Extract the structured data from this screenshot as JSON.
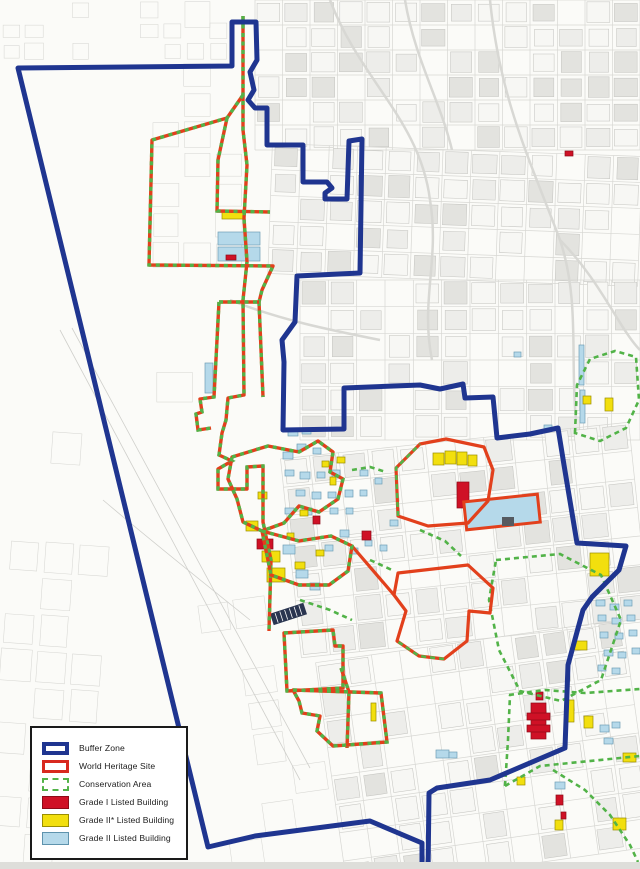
{
  "legend": {
    "items": [
      {
        "key": "buffer-zone",
        "label": "Buffer Zone"
      },
      {
        "key": "world-heritage-site",
        "label": "World Heritage Site"
      },
      {
        "key": "conservation-area",
        "label": "Conservation Area"
      },
      {
        "key": "grade-1-listed",
        "label": "Grade I Listed Building"
      },
      {
        "key": "grade-2-star-listed",
        "label": "Grade II* Listed Building"
      },
      {
        "key": "grade-2-listed",
        "label": "Grade II Listed Building"
      }
    ]
  },
  "map": {
    "width": 640,
    "height": 869,
    "colors": {
      "background": "#fbfbf8",
      "buffer": "#1f3590",
      "whs": "#e2401c",
      "conservation": "#52b348",
      "grade1": "#cf1126",
      "grade1_stroke": "#8e0a18",
      "grade2star": "#f2df0e",
      "grade2star_stroke": "#9a8e00",
      "grade2": "#b5d9ea",
      "grade2_stroke": "#6f9fb5",
      "street_line": "#c6c6c2",
      "street_faint": "#d7d7d3",
      "block_fill_dark": "#e3e3df",
      "block_fill_mid": "#ededea",
      "block_fill_light": "#f7f7f4",
      "road": "#d8d8d4",
      "dark_building": "#2a3550",
      "bottom_strip": "#dededa"
    },
    "streets": {
      "seed": 7,
      "regions": [
        {
          "x": 0,
          "y": 0,
          "w": 230,
          "h": 62,
          "cols": 10,
          "rows": 3,
          "density": 0.55,
          "faint": true,
          "tilt": 0
        },
        {
          "x": 150,
          "y": 0,
          "w": 95,
          "h": 300,
          "cols": 3,
          "rows": 10,
          "density": 0.5,
          "faint": true,
          "tilt": 0
        },
        {
          "x": 255,
          "y": 0,
          "w": 385,
          "h": 150,
          "cols": 14,
          "rows": 6,
          "density": 0.8,
          "faint": false,
          "tilt": 0
        },
        {
          "x": 270,
          "y": 150,
          "w": 370,
          "h": 130,
          "cols": 13,
          "rows": 5,
          "density": 0.75,
          "faint": false,
          "tilt": 2
        },
        {
          "x": 300,
          "y": 280,
          "w": 340,
          "h": 160,
          "cols": 12,
          "rows": 6,
          "density": 0.7,
          "faint": false,
          "tilt": 0
        },
        {
          "x": 290,
          "y": 440,
          "w": 350,
          "h": 200,
          "cols": 12,
          "rows": 7,
          "density": 0.72,
          "faint": false,
          "tilt": -6
        },
        {
          "x": 330,
          "y": 640,
          "w": 310,
          "h": 229,
          "cols": 11,
          "rows": 8,
          "density": 0.68,
          "faint": false,
          "tilt": -8
        },
        {
          "x": 0,
          "y": 430,
          "w": 105,
          "h": 439,
          "cols": 3,
          "rows": 12,
          "density": 0.4,
          "faint": true,
          "tilt": 4
        },
        {
          "x": 210,
          "y": 560,
          "w": 110,
          "h": 309,
          "cols": 3,
          "rows": 9,
          "density": 0.45,
          "faint": true,
          "tilt": -8
        },
        {
          "x": 155,
          "y": 300,
          "w": 80,
          "h": 140,
          "cols": 2,
          "rows": 4,
          "density": 0.4,
          "faint": true,
          "tilt": 0
        }
      ]
    },
    "roads": [
      "M330,0 C360,80 420,120 430,200",
      "M430,200 C440,260 420,300 432,360",
      "M490,0 C500,100 530,160 560,240 C580,300 570,360 576,420",
      "M230,300 C280,320 330,330 380,340",
      "M405,0 C415,60 440,100 452,150",
      "M560,240 C600,280 620,330 640,350"
    ],
    "river_lines": [
      "M60,330 L300,780",
      "M72,328 L310,768",
      "M103,500 C150,540 200,580 250,620"
    ],
    "boundaries": [
      {
        "name": "conservation-ne-everton",
        "style": "green",
        "d": "M575,433 L577,385 L590,359 L615,351 L636,357 L639,400 L626,428 L600,441 Z"
      },
      {
        "name": "conservation-canning",
        "style": "green",
        "d": "M496,560 L560,554 L601,575 L621,620 L601,680 L561,701 L520,691 L499,650 L489,600 Z"
      },
      {
        "name": "conservation-se-band-upper",
        "style": "green",
        "d": "M509,695 L545,690 L585,693 L640,689"
      },
      {
        "name": "conservation-se-band-lower",
        "style": "green",
        "d": "M505,786 L540,766 L580,762 L640,756"
      },
      {
        "name": "conservation-se-connector",
        "style": "green",
        "d": "M505,786 L508,740 L510,695"
      },
      {
        "name": "conservation-se-diagonal",
        "style": "green",
        "d": "M553,770 L585,790 L610,815 L630,845 L638,862"
      },
      {
        "name": "conservation-city-fragment-1",
        "style": "green",
        "d": "M352,470 L370,467 L386,472"
      },
      {
        "name": "conservation-city-fragment-2",
        "style": "green",
        "d": "M420,530 L445,541 L461,556"
      },
      {
        "name": "conservation-city-fragment-3",
        "style": "green",
        "d": "M300,600 L330,610 L352,620"
      },
      {
        "name": "conservation-city-fragment-4",
        "style": "green",
        "d": "M370,560 L392,570"
      },
      {
        "name": "whs-st-georges",
        "style": "red",
        "d": "M398,516 L396,468 L420,444 L446,439 L484,447 L493,470 L488,501 L468,523 L428,526 Z"
      },
      {
        "name": "whs-duke-street",
        "style": "red",
        "d": "M398,573 L468,565 L493,588 L490,613 L469,611 L467,641 L444,659 L419,656 L397,641 L406,611 L394,595 Z"
      },
      {
        "name": "whs-duke-connector",
        "style": "red",
        "d": "M352,546 L394,595"
      },
      {
        "name": "conservation-overlay-stgeorge",
        "style": "green",
        "d": "M398,516 L396,468 L420,444"
      },
      {
        "name": "conservation-overlay-duke",
        "style": "green",
        "d": "M444,659 L419,656 L397,641"
      },
      {
        "name": "whs-north-main",
        "style": "candy",
        "d": "M243,16 L243,130 L247,165 L244,218 L247,262 L243,300 L244,395 L228,398 L226,420 L222,433 L219,455 L232,461 L218,469 L218,489 L247,489 L247,467 L263,466 L263,522 L271,560 L269,631"
      },
      {
        "name": "conservation-north-docks-loop",
        "style": "candy",
        "d": "M243,95 L227,118 L152,140 L149,265 L273,266 L262,290 L259,302"
      },
      {
        "name": "conservation-north-docks-east",
        "style": "candy",
        "d": "M227,118 L218,160 L217,211 L270,212"
      },
      {
        "name": "conservation-princes-west",
        "style": "candy",
        "d": "M219,302 L214,397 L200,399 L202,412 L196,414 L198,430 L211,428"
      },
      {
        "name": "conservation-princes-east",
        "style": "candy",
        "d": "M259,302 L263,397"
      },
      {
        "name": "conservation-princes-top",
        "style": "candy",
        "d": "M219,302 L259,302"
      },
      {
        "name": "whs-albert-dock",
        "style": "candy",
        "d": "M284,633 L333,630 L335,646 L343,646 L343,688 L287,691 Z"
      },
      {
        "name": "whs-wapping",
        "style": "candy",
        "d": "M341,668 L349,692 L347,748"
      },
      {
        "name": "conservation-queens-dock",
        "style": "candy",
        "d": "M293,690 L381,693 L387,742 L333,746 L317,731 L320,716 L302,713 L299,701 Z"
      },
      {
        "name": "whs-commercial-loop-1",
        "style": "candy",
        "d": "M232,457 L268,446 L299,452 L318,441 L333,452 L330,472 L343,479 L338,499 L319,512 L299,506 L284,523 L262,531 L243,522 L237,499 L228,479 Z"
      },
      {
        "name": "whs-commercial-loop-2",
        "style": "candy",
        "d": "M262,531 L299,541 L331,536 L352,546 L348,571 L329,585 L299,585 L271,575 Z"
      },
      {
        "name": "buffer-zone",
        "style": "blue",
        "d": "M18,68 L232,66 L232,22 L256,22 L257,60 L250,72 L254,90 L248,100 L255,108 L267,108 L267,145 L303,145 L303,182 L327,182 L332,188 L325,193 L325,199 L347,199 L349,141 L362,139 L360,273 L297,276 L295,322 L282,340 L284,362 L283,430 L344,429 L344,388 L420,385 L440,389 L463,384 L465,398 L493,397 L497,438 L530,434 L558,428 L564,465 L577,543 L626,546 L619,570 L592,597 L583,610 L568,665 L565,748 L490,780 L437,788 L429,793 L428,875 L422,875 L422,843 L370,821 L255,836 L208,847 Z"
      }
    ],
    "buildings": {
      "grade1": [
        [
          257,
          539,
          16,
          10
        ],
        [
          313,
          516,
          7,
          8
        ],
        [
          362,
          531,
          9,
          9
        ],
        [
          457,
          482,
          12,
          26
        ],
        [
          536,
          692,
          7,
          8
        ],
        [
          531,
          703,
          15,
          36
        ],
        [
          527,
          713,
          23,
          7
        ],
        [
          527,
          725,
          23,
          7
        ],
        [
          565,
          151,
          8,
          5
        ],
        [
          556,
          795,
          7,
          10
        ],
        [
          561,
          812,
          5,
          7
        ],
        [
          226,
          255,
          10,
          5
        ]
      ],
      "grade2star": [
        [
          222,
          212,
          23,
          7
        ],
        [
          433,
          453,
          11,
          12
        ],
        [
          445,
          451,
          11,
          13
        ],
        [
          457,
          452,
          10,
          13
        ],
        [
          468,
          455,
          9,
          11
        ],
        [
          590,
          553,
          19,
          23
        ],
        [
          573,
          641,
          14,
          9
        ],
        [
          565,
          700,
          9,
          22
        ],
        [
          584,
          716,
          9,
          12
        ],
        [
          517,
          777,
          8,
          8
        ],
        [
          555,
          820,
          8,
          10
        ],
        [
          623,
          753,
          13,
          9
        ],
        [
          613,
          818,
          13,
          12
        ],
        [
          583,
          396,
          8,
          8
        ],
        [
          605,
          398,
          8,
          13
        ],
        [
          262,
          551,
          18,
          11
        ],
        [
          267,
          568,
          18,
          14
        ],
        [
          246,
          521,
          12,
          10
        ],
        [
          258,
          492,
          9,
          7
        ],
        [
          300,
          510,
          8,
          6
        ],
        [
          322,
          461,
          7,
          6
        ],
        [
          330,
          477,
          6,
          8
        ],
        [
          295,
          562,
          10,
          7
        ],
        [
          316,
          550,
          8,
          6
        ],
        [
          287,
          533,
          7,
          6
        ],
        [
          371,
          703,
          5,
          18
        ],
        [
          337,
          457,
          8,
          6
        ]
      ],
      "grade2": [
        [
          218,
          232,
          42,
          13
        ],
        [
          218,
          247,
          42,
          14
        ],
        [
          205,
          363,
          8,
          30
        ],
        [
          283,
          452,
          10,
          7
        ],
        [
          297,
          444,
          9,
          6
        ],
        [
          313,
          448,
          8,
          6
        ],
        [
          285,
          470,
          9,
          6
        ],
        [
          300,
          472,
          10,
          7
        ],
        [
          317,
          472,
          8,
          6
        ],
        [
          332,
          470,
          8,
          7
        ],
        [
          296,
          490,
          9,
          6
        ],
        [
          312,
          492,
          9,
          7
        ],
        [
          328,
          492,
          8,
          6
        ],
        [
          345,
          490,
          8,
          7
        ],
        [
          302,
          508,
          10,
          7
        ],
        [
          330,
          508,
          8,
          6
        ],
        [
          346,
          508,
          7,
          6
        ],
        [
          285,
          508,
          9,
          6
        ],
        [
          360,
          470,
          8,
          6
        ],
        [
          360,
          490,
          7,
          6
        ],
        [
          375,
          478,
          7,
          6
        ],
        [
          340,
          530,
          9,
          7
        ],
        [
          325,
          545,
          8,
          6
        ],
        [
          350,
          548,
          8,
          6
        ],
        [
          365,
          540,
          7,
          6
        ],
        [
          390,
          520,
          8,
          6
        ],
        [
          380,
          545,
          7,
          6
        ],
        [
          288,
          430,
          10,
          6
        ],
        [
          302,
          428,
          9,
          6
        ],
        [
          296,
          570,
          12,
          8
        ],
        [
          310,
          583,
          10,
          7
        ],
        [
          283,
          545,
          12,
          9
        ],
        [
          596,
          600,
          9,
          6
        ],
        [
          610,
          604,
          9,
          6
        ],
        [
          624,
          600,
          8,
          6
        ],
        [
          598,
          615,
          8,
          6
        ],
        [
          612,
          618,
          9,
          6
        ],
        [
          627,
          615,
          8,
          6
        ],
        [
          600,
          632,
          8,
          6
        ],
        [
          615,
          633,
          8,
          6
        ],
        [
          629,
          630,
          8,
          6
        ],
        [
          604,
          650,
          9,
          6
        ],
        [
          618,
          652,
          8,
          6
        ],
        [
          632,
          648,
          8,
          6
        ],
        [
          598,
          665,
          8,
          6
        ],
        [
          612,
          668,
          8,
          6
        ],
        [
          600,
          725,
          9,
          7
        ],
        [
          612,
          722,
          8,
          6
        ],
        [
          604,
          738,
          9,
          6
        ],
        [
          555,
          782,
          10,
          7
        ],
        [
          436,
          750,
          13,
          8
        ],
        [
          449,
          752,
          8,
          6
        ],
        [
          579,
          345,
          5,
          40
        ],
        [
          580,
          390,
          5,
          33
        ],
        [
          544,
          425,
          8,
          6
        ],
        [
          514,
          352,
          7,
          5
        ]
      ]
    },
    "special": {
      "museum_block": [
        465,
        498,
        74,
        28
      ],
      "striped_warehouse": [
        271,
        608,
        35,
        12
      ],
      "dark_building": [
        502,
        517,
        12,
        9
      ]
    }
  }
}
